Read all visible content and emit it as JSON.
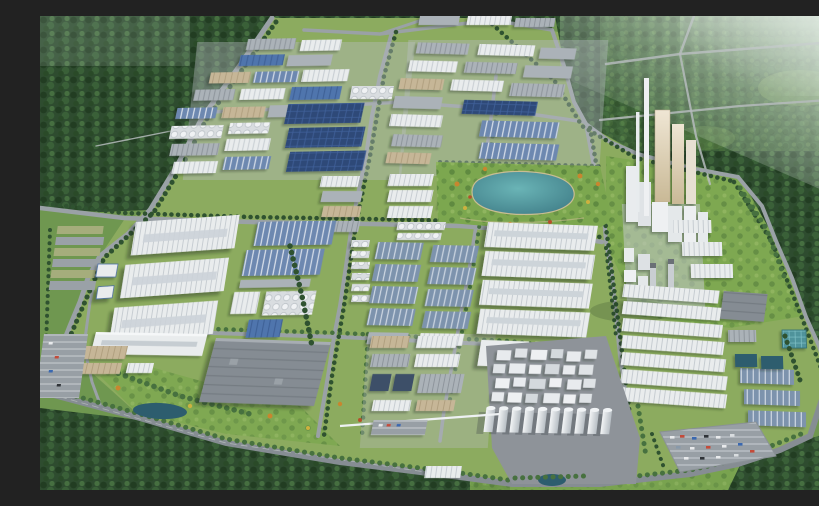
{
  "scene": {
    "title": "Aerial 3D rendering of an industrial park",
    "description": "Bird's-eye photorealistic 3D rendering of a large industrial park surrounded by dense green forest: grids of factory halls with blue, white, gray and dark solar-panel roofs, a kidney-shaped teal lake in a landscaped park, a white processing plant with tall chimneys and silo towers on the right, a tank farm with white cylindrical silos at the lower center, tree-lined roads, striped parking lots with cars, water-treatment pools and small retention ponds; hazy atmosphere toward the top-right corner.",
    "style": "daytime architectural render, oblique aerial view",
    "visible_text": "none"
  },
  "palette": {
    "forest-dark": "#2e4c2f",
    "forest-deep": "#223d22",
    "forest-mid": "#3a6038",
    "forest-light": "#4c7643",
    "meadow": "#6f9750",
    "lawn": "#8cab5f",
    "park-green": "#7ca74f",
    "tree-line": "#2f5230",
    "road": "#9aa1a6",
    "road-dark": "#868d93",
    "roof-white": "#e9eced",
    "roof-gray": "#abb2b8",
    "roof-gray-dark": "#858c93",
    "roof-blue": "#4f74ad",
    "roof-blue-ridge": "#6d88b0",
    "roof-navy": "#2e4a78",
    "roof-steel": "#3e5068",
    "steel-light": "#7d93ad",
    "wall-tan": "#c6b697",
    "concrete": "#b9bec2",
    "pad-gray": "#8e9399",
    "lake-teal": "#4e939c",
    "pond-dark": "#2d5d6e",
    "pool-teal": "#4f939b",
    "haze": "#e4ede6",
    "autumn-orange": "#c8862f",
    "autumn-yellow": "#cdb13f",
    "car-red": "#c44b3a",
    "car-blue": "#3a68b0"
  },
  "features": {
    "forest": "dense dark-green tree cover on the upper-left, right edge and bottom",
    "lake": "kidney-shaped teal lake in a landscaped park at center-top",
    "factory_blocks": "rectangular factory halls with blue, white, gray and solar-panel roofs arranged in road-divided blocks",
    "processing_plant": "white chimney-and-tower plant complex on the right side",
    "tank_farm": "row of white cylindrical silos on a gray pad at lower center",
    "warehouse_rows": "long white ribbed warehouses lower right and center",
    "roads": "tree-lined gray roads dividing the park into blocks",
    "parking": "striped parking lots with scattered cars, lower right and lower left",
    "pools": "blue water-treatment basins at the lower right",
    "ponds": "small dark retention ponds near the bottom"
  }
}
